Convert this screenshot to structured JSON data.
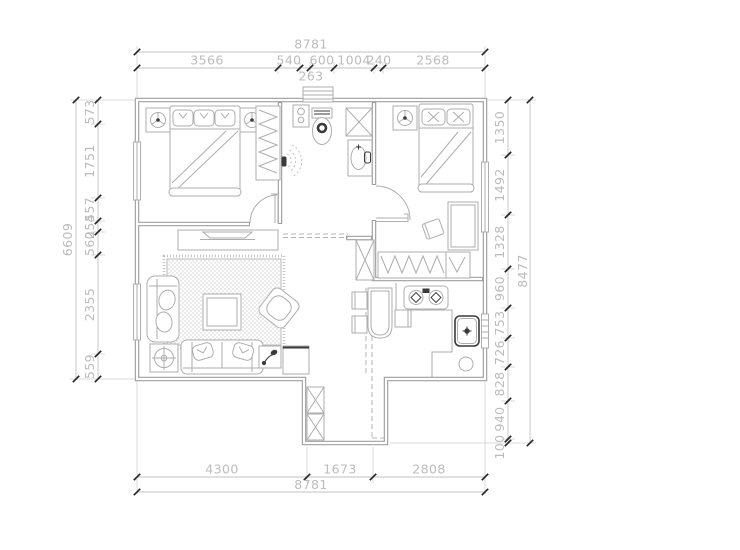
{
  "drawing": {
    "kind": "apartment floor plan"
  },
  "colors": {
    "wall": "#9f9f9f",
    "furniture": "#aeaeae",
    "dimension_text": "#bcbcbc",
    "tick": "#262626",
    "dark_detail": "#3a3a3a",
    "paper": "#ffffff"
  },
  "dimensions": {
    "top": {
      "overall": "8781",
      "segments": [
        "3566",
        "540",
        "600",
        "1004",
        "240",
        "2568"
      ],
      "small_segment": "263"
    },
    "bottom": {
      "overall": "8781",
      "segments": [
        "4300",
        "1673",
        "2808"
      ]
    },
    "left": {
      "overall": "6609",
      "segments": [
        "573",
        "1751",
        "557",
        "254",
        "560",
        "2355",
        "559"
      ]
    },
    "right": {
      "overall": "8477",
      "segments": [
        "1350",
        "1492",
        "1328",
        "960",
        "753",
        "726",
        "828",
        "940",
        "100"
      ]
    }
  }
}
